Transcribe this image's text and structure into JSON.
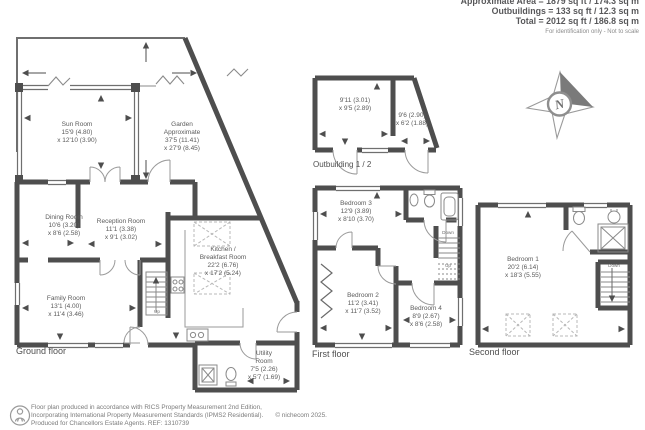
{
  "header": {
    "area_line": "Approximate Area = 1879 sq ft / 174.3 sq m",
    "outbuildings_line": "Outbuildings = 133 sq ft / 12.3 sq m",
    "total_line": "Total = 2012 sq ft / 186.8 sq m",
    "disclaimer": "For identification only - Not to scale"
  },
  "compass": {
    "north_label": "N"
  },
  "ground_floor": {
    "label": "Ground floor",
    "stairs_up": "Up",
    "sun_room": {
      "name": "Sun Room",
      "dim1": "15'9 (4.80)",
      "dim2": "x 12'10 (3.90)"
    },
    "garden": {
      "name": "Garden",
      "line2": "Approximate",
      "dim1": "37'5 (11.41)",
      "dim2": "x 27'9 (8.45)"
    },
    "dining_room": {
      "name": "Dining Room",
      "dim1": "10'6 (3.20)",
      "dim2": "x 8'6 (2.58)"
    },
    "reception_room": {
      "name": "Reception Room",
      "dim1": "11'1 (3.38)",
      "dim2": "x 9'1 (3.02)"
    },
    "kitchen": {
      "name": "Kitchen /",
      "line2": "Breakfast Room",
      "dim1": "22'2 (6.76)",
      "dim2": "x 17'2 (5.24)"
    },
    "family_room": {
      "name": "Family Room",
      "dim1": "13'1 (4.00)",
      "dim2": "x 11'4 (3.46)"
    },
    "utility_room": {
      "name": "Utility",
      "line2": "Room",
      "dim1": "7'5 (2.26)",
      "dim2": "x 5'7 (1.69)"
    }
  },
  "outbuilding": {
    "label": "Outbuilding 1 / 2",
    "room1": {
      "dim1": "9'11 (3.01)",
      "dim2": "x 9'5 (2.89)"
    },
    "room2": {
      "dim1": "9'6 (2.90)",
      "dim2": "x 6'2 (1.88)"
    }
  },
  "first_floor": {
    "label": "First floor",
    "stairs_down": "Down",
    "stairs_up": "Up",
    "bedroom3": {
      "name": "Bedroom 3",
      "dim1": "12'9 (3.89)",
      "dim2": "x 8'10 (3.70)"
    },
    "bedroom2": {
      "name": "Bedroom 2",
      "dim1": "11'2 (3.41)",
      "dim2": "x 11'7 (3.52)"
    },
    "bedroom4": {
      "name": "Bedroom 4",
      "dim1": "8'9 (2.67)",
      "dim2": "x 8'6 (2.58)"
    }
  },
  "second_floor": {
    "label": "Second floor",
    "stairs_down": "Down",
    "bedroom1": {
      "name": "Bedroom 1",
      "dim1": "20'2 (6.14)",
      "dim2": "x 18'3 (5.55)"
    }
  },
  "footer": {
    "line1": "Floor plan produced in accordance with RICS Property Measurement 2nd Edition,",
    "line2": "Incorporating International Property Measurement Standards (IPMS2 Residential).",
    "copyright": "© nichecom 2025.",
    "line3": "Produced for Chancellors Estate Agents.   REF:  1310739"
  },
  "colors": {
    "wall": "#4e4e4e",
    "text": "#5b5b5b",
    "accent_fill": "#7a7a7a"
  }
}
